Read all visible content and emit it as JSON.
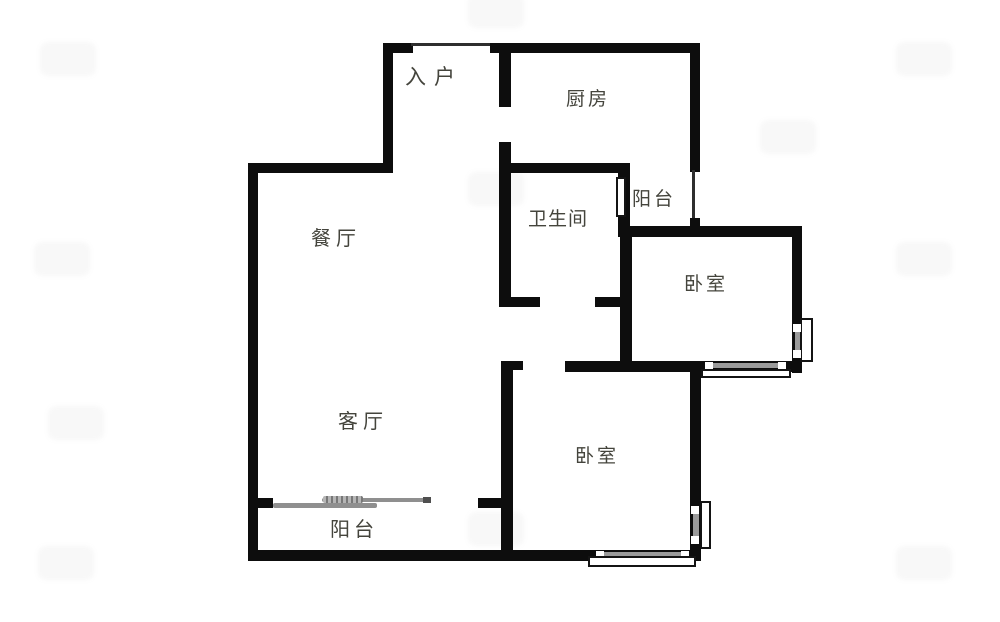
{
  "title": "两室户型图",
  "rooms": {
    "entry": {
      "label": "入户"
    },
    "kitchen": {
      "label": "厨房"
    },
    "balcony_top": {
      "label": "阳台"
    },
    "bathroom": {
      "label": "卫生间"
    },
    "bedroom_right": {
      "label": "卧室"
    },
    "dining": {
      "label": "餐厅"
    },
    "living": {
      "label": "客厅"
    },
    "bedroom_bottom": {
      "label": "卧室"
    },
    "balcony_bottom": {
      "label": "阳台"
    }
  },
  "colors": {
    "wall": "#0d0d0d",
    "label_text": "#44443c",
    "sliding_door_bar": "#8f8f8f",
    "background": "#ffffff"
  }
}
